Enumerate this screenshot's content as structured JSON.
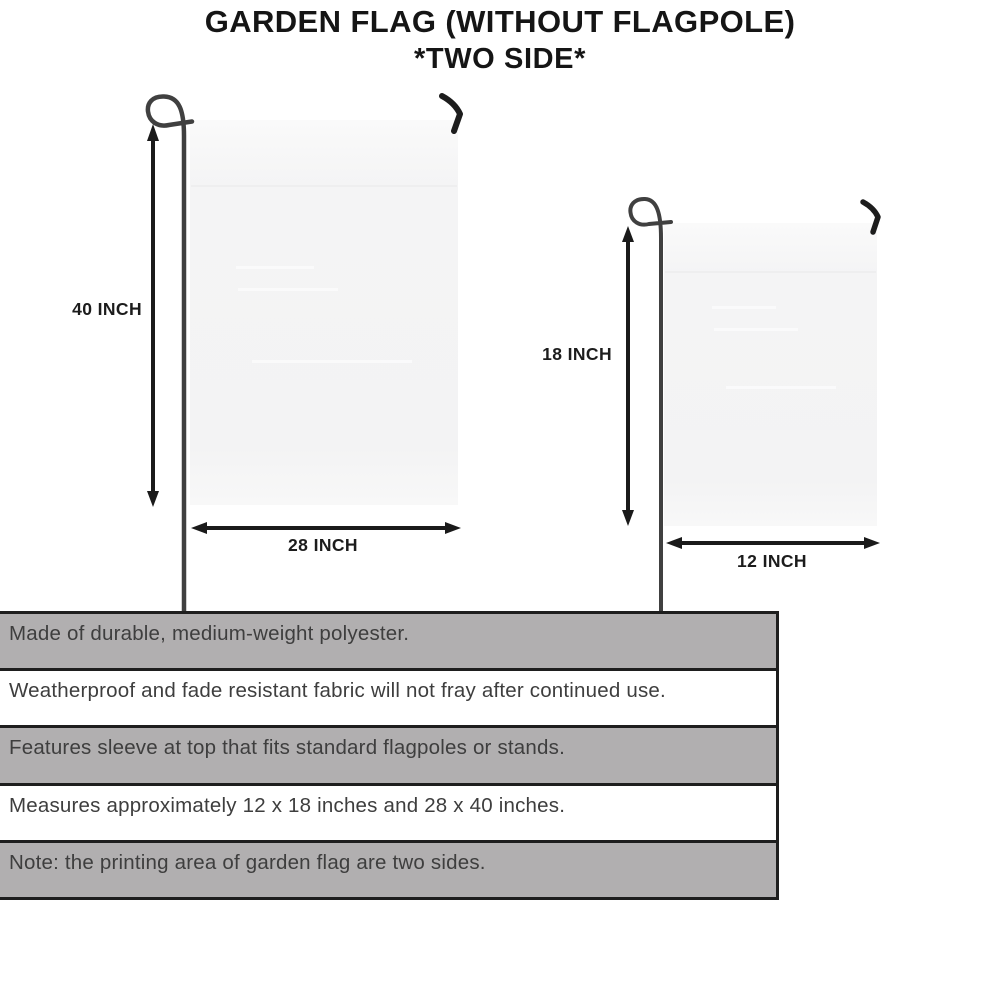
{
  "title": {
    "line1": "GARDEN FLAG (WITHOUT FLAGPOLE)",
    "line2": "*TWO SIDE*"
  },
  "diagram": {
    "large_flag": {
      "height_label": "40 INCH",
      "width_label": "28 INCH"
    },
    "small_flag": {
      "height_label": "18 INCH",
      "width_label": "12 INCH"
    }
  },
  "features": {
    "rows": [
      {
        "text": "Made of durable, medium-weight polyester.",
        "shaded": true
      },
      {
        "text": "Weatherproof and fade resistant fabric will not fray after continued use.",
        "shaded": false
      },
      {
        "text": "Features sleeve at top that fits standard flagpoles or stands.",
        "shaded": true
      },
      {
        "text": "Measures approximately 12 x 18 inches and 28 x 40 inches.",
        "shaded": false
      },
      {
        "text": "Note: the printing area of garden flag are two sides.",
        "shaded": true
      }
    ]
  },
  "colors": {
    "shaded_row_bg": "#b1afb0",
    "plain_row_bg": "#ffffff",
    "table_border": "#1e1e1e",
    "row_text": "#3e3e3e",
    "title_text": "#151515",
    "flag_fill": "#f4f4f5",
    "pole_stroke": "#404040",
    "arrow_stroke": "#1a1a1a"
  }
}
